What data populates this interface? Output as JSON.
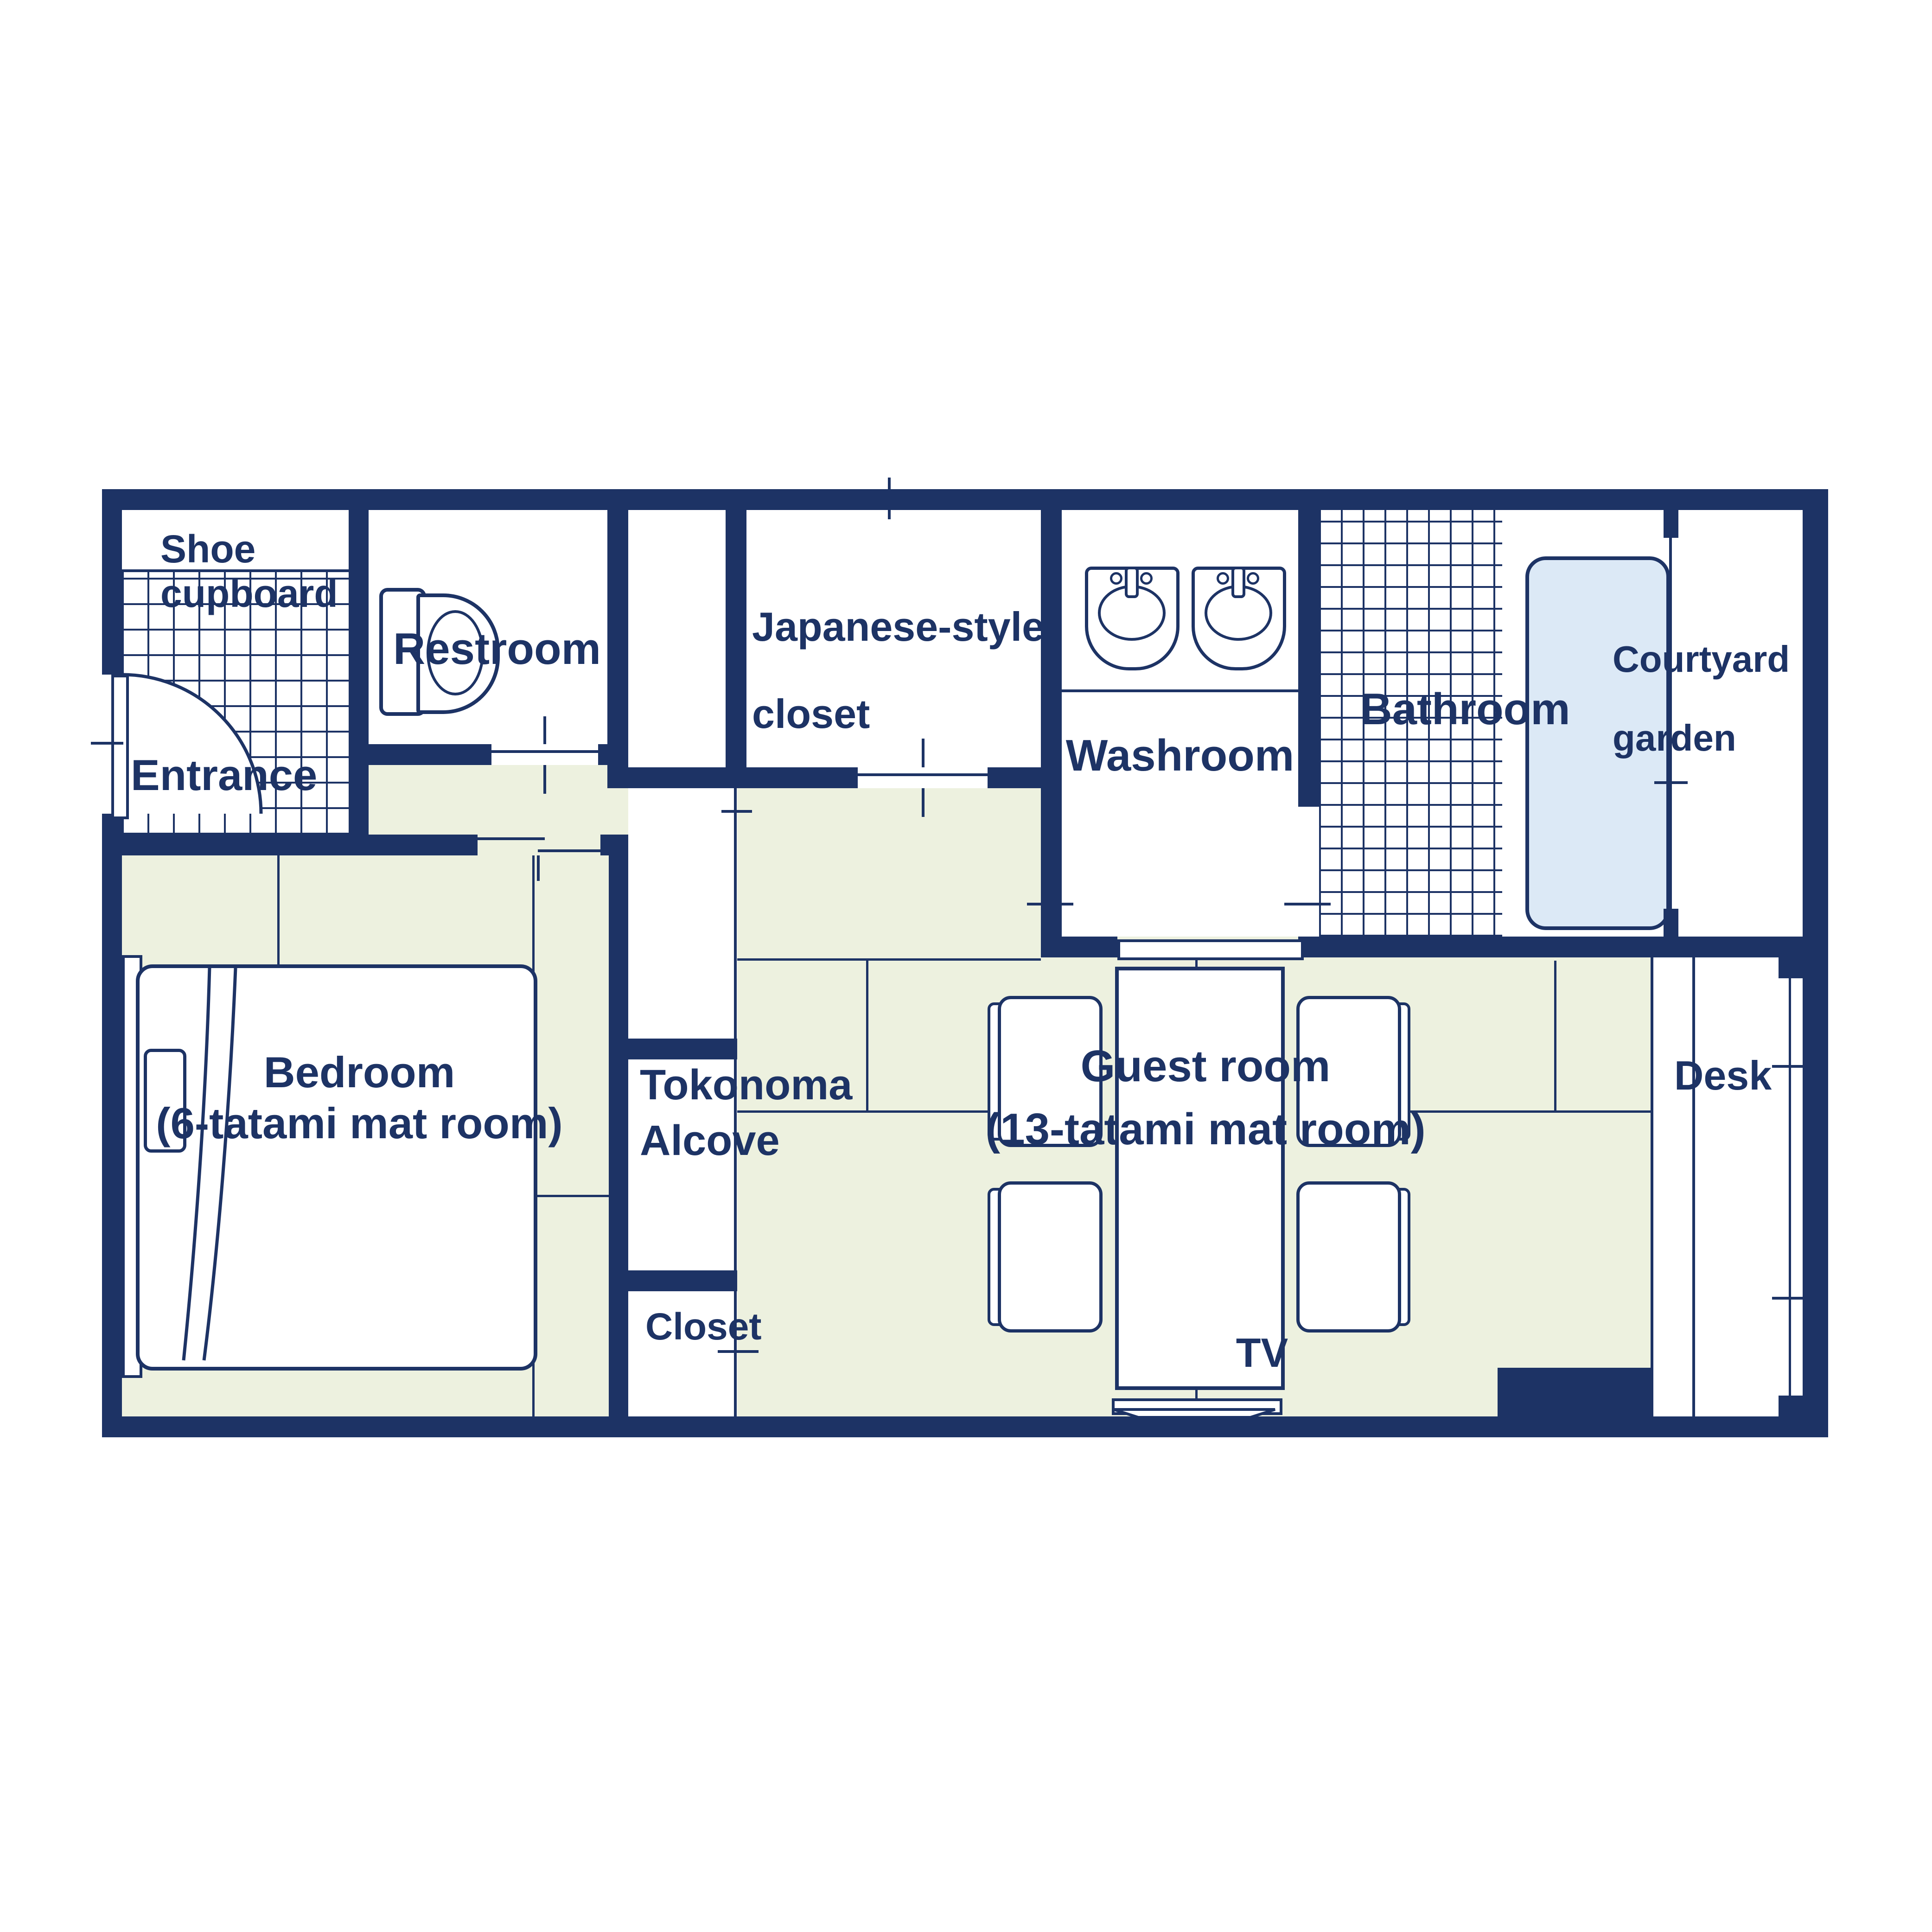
{
  "title": "Japanese-style guest room floor plan",
  "colors": {
    "wall_navy": "#1d3365",
    "tatami_green": "#edf1df",
    "bathtub_blue": "#dce9f6",
    "floor_white": "#ffffff"
  },
  "rooms": {
    "shoe_cupboard": {
      "line1": "Shoe",
      "line2": "cupboard"
    },
    "entrance": {
      "label": "Entrance"
    },
    "restroom": {
      "label": "Restroom"
    },
    "japanese_closet": {
      "line1": "Japanese-style",
      "line2": "closet"
    },
    "washroom": {
      "label": "Washroom"
    },
    "bathroom": {
      "label": "Bathroom"
    },
    "courtyard": {
      "line1": "Courtyard",
      "line2": "garden"
    },
    "bedroom": {
      "line1": "Bedroom",
      "line2": "(6-tatami mat room)"
    },
    "tokonoma": {
      "line1": "Tokonoma",
      "line2": "Alcove"
    },
    "closet": {
      "label": "Closet"
    },
    "guest_room": {
      "line1": "Guest room",
      "line2": "(13-tatami mat room)"
    },
    "desk": {
      "label": "Desk"
    },
    "tv": {
      "label": "TV"
    }
  }
}
